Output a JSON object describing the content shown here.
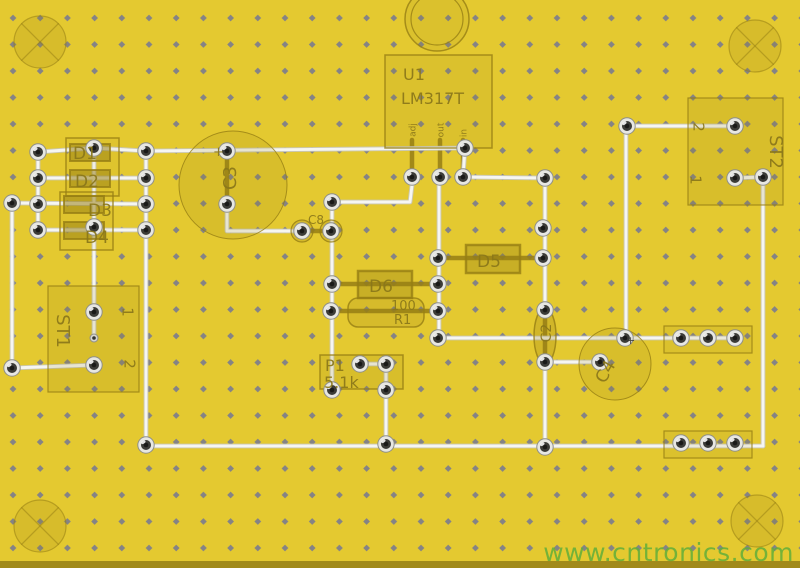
{
  "page": {
    "type": "pcb-layout-view"
  },
  "watermark": {
    "text": "www.cntronics.com",
    "color": "#60ae3a"
  },
  "board": {
    "width": 800,
    "height": 568,
    "background": "#e4c930",
    "dot_color": "#7f7f8a",
    "silk_color_rgb": "150,126,20",
    "label_color": "#8a771a",
    "trace_color": "#f6f6f2",
    "trace_under_color": "#c6c6bf",
    "pad_ring_color": "#e7e7e2",
    "pad_hole_color": "#1a1a18",
    "bottom_strip_color": "rgba(80,62,0,0.45)"
  },
  "grid": {
    "tile_w": 27.2,
    "tile_h": 26.5,
    "dot_x": 13,
    "dot_y": 18,
    "dot_r": 3.4
  },
  "holes": {
    "radius": 26,
    "centers": [
      [
        40,
        42
      ],
      [
        755,
        46
      ],
      [
        40,
        526
      ],
      [
        757,
        521
      ]
    ]
  },
  "vias": [
    [
      94,
      338
    ]
  ],
  "pads": [
    [
      12,
      203
    ],
    [
      12,
      368
    ],
    [
      38,
      152
    ],
    [
      38,
      178
    ],
    [
      38,
      204
    ],
    [
      38,
      230
    ],
    [
      94,
      148
    ],
    [
      94,
      227
    ],
    [
      94,
      312
    ],
    [
      94,
      365
    ],
    [
      146,
      151
    ],
    [
      146,
      178
    ],
    [
      146,
      204
    ],
    [
      146,
      230
    ],
    [
      146,
      445
    ],
    [
      227,
      151
    ],
    [
      227,
      204
    ],
    [
      302,
      231
    ],
    [
      331,
      231
    ],
    [
      332,
      202
    ],
    [
      332,
      284
    ],
    [
      331,
      311
    ],
    [
      332,
      390
    ],
    [
      360,
      364
    ],
    [
      386,
      364
    ],
    [
      386,
      390
    ],
    [
      386,
      444
    ],
    [
      412,
      177
    ],
    [
      440,
      177
    ],
    [
      463,
      177
    ],
    [
      465,
      148
    ],
    [
      438,
      258
    ],
    [
      438,
      284
    ],
    [
      438,
      311
    ],
    [
      438,
      338
    ],
    [
      543,
      228
    ],
    [
      543,
      258
    ],
    [
      545,
      178
    ],
    [
      545,
      310
    ],
    [
      545,
      362
    ],
    [
      545,
      447
    ],
    [
      600,
      362
    ],
    [
      625,
      338
    ],
    [
      627,
      126
    ],
    [
      735,
      126
    ],
    [
      735,
      178
    ],
    [
      763,
      177
    ],
    [
      681,
      338
    ],
    [
      708,
      338
    ],
    [
      735,
      338
    ],
    [
      681,
      443
    ],
    [
      708,
      443
    ],
    [
      735,
      443
    ]
  ],
  "leads": [
    [
      [
        412,
        140
      ],
      [
        412,
        175
      ]
    ],
    [
      [
        440,
        140
      ],
      [
        440,
        175
      ]
    ],
    [
      [
        463,
        140
      ],
      [
        463,
        175
      ]
    ],
    [
      [
        438,
        258
      ],
      [
        543,
        258
      ]
    ],
    [
      [
        332,
        284
      ],
      [
        438,
        284
      ]
    ],
    [
      [
        331,
        311
      ],
      [
        438,
        311
      ]
    ],
    [
      [
        545,
        312
      ],
      [
        545,
        360
      ]
    ],
    [
      [
        303,
        231
      ],
      [
        330,
        231
      ]
    ],
    [
      [
        227,
        153
      ],
      [
        227,
        202
      ]
    ]
  ],
  "traces": [
    [
      [
        38,
        152
      ],
      [
        94,
        148
      ],
      [
        146,
        151
      ]
    ],
    [
      [
        38,
        178
      ],
      [
        146,
        178
      ]
    ],
    [
      [
        12,
        203
      ],
      [
        146,
        204
      ]
    ],
    [
      [
        38,
        230
      ],
      [
        146,
        230
      ]
    ],
    [
      [
        38,
        152
      ],
      [
        38,
        230
      ]
    ],
    [
      [
        94,
        148
      ],
      [
        94,
        338
      ]
    ],
    [
      [
        12,
        203
      ],
      [
        12,
        368
      ]
    ],
    [
      [
        12,
        368
      ],
      [
        94,
        365
      ]
    ],
    [
      [
        146,
        151
      ],
      [
        465,
        148
      ]
    ],
    [
      [
        146,
        151
      ],
      [
        146,
        445
      ]
    ],
    [
      [
        227,
        204
      ],
      [
        227,
        231
      ],
      [
        302,
        231
      ]
    ],
    [
      [
        332,
        202
      ],
      [
        410,
        202
      ],
      [
        413,
        177
      ]
    ],
    [
      [
        332,
        202
      ],
      [
        332,
        390
      ]
    ],
    [
      [
        465,
        148
      ],
      [
        463,
        177
      ]
    ],
    [
      [
        463,
        177
      ],
      [
        545,
        178
      ]
    ],
    [
      [
        439,
        177
      ],
      [
        439,
        338
      ]
    ],
    [
      [
        439,
        338
      ],
      [
        735,
        338
      ]
    ],
    [
      [
        545,
        178
      ],
      [
        545,
        310
      ]
    ],
    [
      [
        545,
        362
      ],
      [
        545,
        447
      ]
    ],
    [
      [
        545,
        362
      ],
      [
        600,
        362
      ]
    ],
    [
      [
        627,
        126
      ],
      [
        735,
        126
      ]
    ],
    [
      [
        626,
        126
      ],
      [
        626,
        337
      ]
    ],
    [
      [
        735,
        178
      ],
      [
        763,
        177
      ]
    ],
    [
      [
        763,
        177
      ],
      [
        763,
        446
      ]
    ],
    [
      [
        146,
        446
      ],
      [
        763,
        446
      ]
    ],
    [
      [
        360,
        364
      ],
      [
        386,
        364
      ]
    ],
    [
      [
        386,
        364
      ],
      [
        386,
        444
      ]
    ]
  ],
  "silk": [
    {
      "name": "bridge-box-d1-d2",
      "kind": "rect",
      "x": 66,
      "y": 138,
      "w": 53,
      "h": 58,
      "alpha": 0.06,
      "sw": 1.5
    },
    {
      "name": "bridge-box-d3-d4",
      "kind": "rect",
      "x": 60,
      "y": 192,
      "w": 53,
      "h": 58,
      "alpha": 0.06,
      "sw": 1.5
    },
    {
      "name": "diode-d1-body",
      "kind": "rect",
      "x": 70,
      "y": 144,
      "w": 40,
      "h": 17,
      "alpha": 0.5,
      "sw": 2
    },
    {
      "name": "diode-d2-body",
      "kind": "rect",
      "x": 70,
      "y": 170,
      "w": 40,
      "h": 17,
      "alpha": 0.5,
      "sw": 2
    },
    {
      "name": "diode-d3-body",
      "kind": "rect",
      "x": 64,
      "y": 196,
      "w": 40,
      "h": 17,
      "alpha": 0.5,
      "sw": 2
    },
    {
      "name": "diode-d4-body",
      "kind": "rect",
      "x": 64,
      "y": 222,
      "w": 40,
      "h": 17,
      "alpha": 0.5,
      "sw": 2
    },
    {
      "name": "cap-c3-outline",
      "kind": "circle",
      "cx": 233,
      "cy": 185,
      "r": 54,
      "alpha": 0.15,
      "sw": 1
    },
    {
      "name": "ic-u1-outline",
      "kind": "rect",
      "x": 385,
      "y": 55,
      "w": 107,
      "h": 93,
      "alpha": 0.1,
      "sw": 1.5
    },
    {
      "name": "ic-u1-tab",
      "kind": "circle",
      "cx": 437,
      "cy": 19,
      "r": 32,
      "alpha": 0.1,
      "sw": 1.5
    },
    {
      "name": "ic-u1-tab-inner",
      "kind": "circle",
      "cx": 437,
      "cy": 19,
      "r": 26,
      "alpha": 0,
      "sw": 1.2
    },
    {
      "name": "diode-d5-body",
      "kind": "rect",
      "x": 466,
      "y": 245,
      "w": 54,
      "h": 28,
      "alpha": 0.35,
      "sw": 2.5
    },
    {
      "name": "diode-d6-body",
      "kind": "rect",
      "x": 358,
      "y": 271,
      "w": 54,
      "h": 27,
      "alpha": 0.35,
      "sw": 2.5
    },
    {
      "name": "resistor-r1-outline",
      "kind": "rect",
      "x": 348,
      "y": 298,
      "w": 76,
      "h": 29,
      "rx": 10,
      "alpha": 0.18,
      "sw": 1.5
    },
    {
      "name": "trimmer-p1-outline",
      "kind": "rect",
      "x": 320,
      "y": 355,
      "w": 83,
      "h": 34,
      "alpha": 0.15,
      "sw": 1.5
    },
    {
      "name": "cap-c2-outline",
      "kind": "ellipse",
      "cx": 545,
      "cy": 336,
      "rx": 11,
      "ry": 28,
      "alpha": 0.25,
      "sw": 1.5
    },
    {
      "name": "cap-c4-outline",
      "kind": "circle",
      "cx": 615,
      "cy": 364,
      "r": 36,
      "alpha": 0.15,
      "sw": 1
    },
    {
      "name": "connector-st1-outline",
      "kind": "rect",
      "x": 48,
      "y": 286,
      "w": 91,
      "h": 106,
      "alpha": 0.15,
      "sw": 1.2
    },
    {
      "name": "connector-st2-outline",
      "kind": "rect",
      "x": 688,
      "y": 98,
      "w": 95,
      "h": 107,
      "alpha": 0.15,
      "sw": 1.2
    },
    {
      "name": "jumper-block-top-outline",
      "kind": "rect",
      "x": 664,
      "y": 326,
      "w": 88,
      "h": 27,
      "alpha": 0.1,
      "sw": 1.2
    },
    {
      "name": "jumper-block-bottom-outline",
      "kind": "rect",
      "x": 664,
      "y": 431,
      "w": 88,
      "h": 27,
      "alpha": 0.1,
      "sw": 1.2
    },
    {
      "name": "cap-c8-ring-left",
      "kind": "circle",
      "cx": 302,
      "cy": 231,
      "r": 11,
      "alpha": 0.2,
      "sw": 1.2
    },
    {
      "name": "cap-c8-ring-right",
      "kind": "circle",
      "cx": 331,
      "cy": 231,
      "r": 11,
      "alpha": 0.2,
      "sw": 1.2
    }
  ],
  "labels": [
    {
      "name": "label-d1",
      "t": "D1",
      "x": 73,
      "y": 159,
      "s": 17
    },
    {
      "name": "label-d2",
      "t": "D2",
      "x": 75,
      "y": 187,
      "s": 17
    },
    {
      "name": "label-d3",
      "t": "D3",
      "x": 88,
      "y": 216,
      "s": 17
    },
    {
      "name": "label-d4",
      "t": "D4",
      "x": 85,
      "y": 243,
      "s": 17
    },
    {
      "name": "label-c3",
      "t": "C3",
      "x": 231,
      "y": 178,
      "s": 18,
      "r": -90,
      "a": "middle"
    },
    {
      "name": "label-c3-polarity",
      "t": "+",
      "x": 213,
      "y": 156,
      "s": 13
    },
    {
      "name": "label-c8",
      "t": "C8",
      "x": 308,
      "y": 224,
      "s": 12
    },
    {
      "name": "label-u1",
      "t": "U1",
      "x": 403,
      "y": 80,
      "s": 16
    },
    {
      "name": "label-u1-part",
      "t": "LM317T",
      "x": 401,
      "y": 104,
      "s": 16
    },
    {
      "name": "label-u1-pin-adj",
      "t": "adj",
      "x": 413,
      "y": 130,
      "s": 9,
      "r": -90,
      "a": "middle"
    },
    {
      "name": "label-u1-pin-out",
      "t": "out",
      "x": 441,
      "y": 130,
      "s": 9,
      "r": -90,
      "a": "middle"
    },
    {
      "name": "label-u1-pin-in",
      "t": "in",
      "x": 464,
      "y": 133,
      "s": 9,
      "r": -90,
      "a": "middle"
    },
    {
      "name": "label-d5",
      "t": "D5",
      "x": 477,
      "y": 267,
      "s": 17
    },
    {
      "name": "label-d6",
      "t": "D6",
      "x": 369,
      "y": 292,
      "s": 17
    },
    {
      "name": "label-r1-value",
      "t": "100",
      "x": 391,
      "y": 310,
      "s": 13
    },
    {
      "name": "label-r1",
      "t": "R1",
      "x": 394,
      "y": 324,
      "s": 13
    },
    {
      "name": "label-p1",
      "t": "P1",
      "x": 325,
      "y": 371,
      "s": 16
    },
    {
      "name": "label-p1-value",
      "t": "5.1k",
      "x": 324,
      "y": 388,
      "s": 16
    },
    {
      "name": "label-c2",
      "t": "C2",
      "x": 547,
      "y": 333,
      "s": 14,
      "r": -90,
      "a": "middle"
    },
    {
      "name": "label-c4",
      "t": "C4",
      "x": 606,
      "y": 372,
      "s": 17,
      "r": -60,
      "a": "middle"
    },
    {
      "name": "label-c4-polarity",
      "t": "+",
      "x": 626,
      "y": 344,
      "s": 11,
      "c": "#3a3a35"
    },
    {
      "name": "label-st1",
      "t": "ST1",
      "x": 62,
      "y": 331,
      "s": 18,
      "r": 90,
      "a": "middle"
    },
    {
      "name": "label-st1-pin1",
      "t": "1",
      "x": 127,
      "y": 312,
      "s": 15,
      "r": 90,
      "a": "middle"
    },
    {
      "name": "label-st1-pin2",
      "t": "2",
      "x": 129,
      "y": 364,
      "s": 15,
      "r": 90,
      "a": "middle"
    },
    {
      "name": "label-st2",
      "t": "ST2",
      "x": 775,
      "y": 152,
      "s": 18,
      "r": 90,
      "a": "middle"
    },
    {
      "name": "label-st2-pin2",
      "t": "2",
      "x": 698,
      "y": 127,
      "s": 15,
      "r": 90,
      "a": "middle"
    },
    {
      "name": "label-st2-pin1",
      "t": "1",
      "x": 695,
      "y": 180,
      "s": 15,
      "r": 90,
      "a": "middle"
    }
  ]
}
